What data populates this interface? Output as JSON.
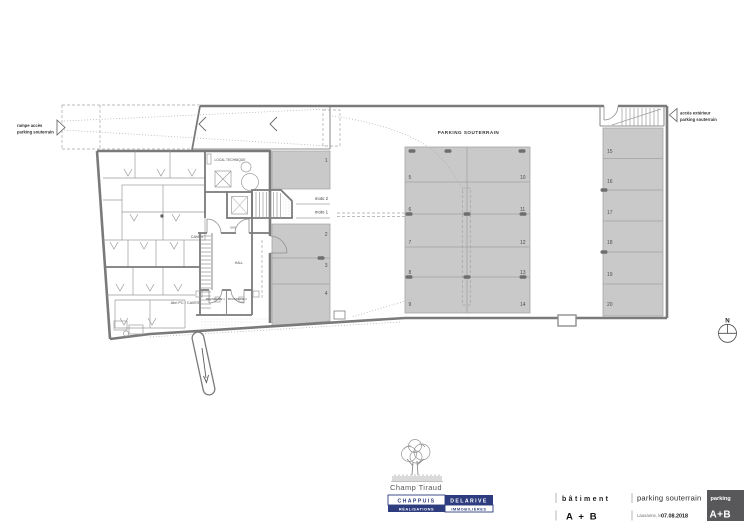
{
  "page": {
    "background": "#ffffff"
  },
  "plan": {
    "colors": {
      "wall": "#7a7a7a",
      "parking_fill": "#c9c9c9",
      "pillar": "#6e6e6e",
      "text": "#3d3d3d"
    },
    "annotations": {
      "ramp_line1": "rampe accès",
      "ramp_line2": "parking souterrain",
      "exterior_line1": "accès extérieur",
      "exterior_line2": "parking souterrain",
      "hall_title": "PARKING SOUTERRAIN",
      "north": "N"
    },
    "rooms": {
      "local_technique": "LOCAL TECHNIQUE",
      "caves": "CAVES",
      "abri_pc": "Abri PC / CAVES",
      "sas": "SAS",
      "hall": "HALL",
      "buanderie_1": "BUANDERIE 1",
      "buanderie_2": "BUANDERIE 2"
    },
    "moto": {
      "moto2": "moto 2",
      "moto1": "moto 1"
    },
    "spaces": [
      "1",
      "2",
      "3",
      "4",
      "5",
      "6",
      "7",
      "8",
      "9",
      "10",
      "11",
      "12",
      "13",
      "14",
      "15",
      "16",
      "17",
      "18",
      "19",
      "20"
    ]
  },
  "title_block": {
    "logo_name": "Champ Tiraud",
    "brand": {
      "row1": [
        "CHAPPUIS",
        "DELARIVE"
      ],
      "row2": [
        "RÉALISATIONS",
        "IMMOBILIÈRES"
      ],
      "navy": "#2d3c7e"
    },
    "batiment": {
      "label": "bâtiment",
      "value": "A + B"
    },
    "document": {
      "title": "parking souterrain",
      "place_label": "Lausanne, le",
      "date": "07.08.2018"
    },
    "badge": {
      "top": "parking",
      "bottom": "A+B",
      "background": "#58585a"
    }
  }
}
